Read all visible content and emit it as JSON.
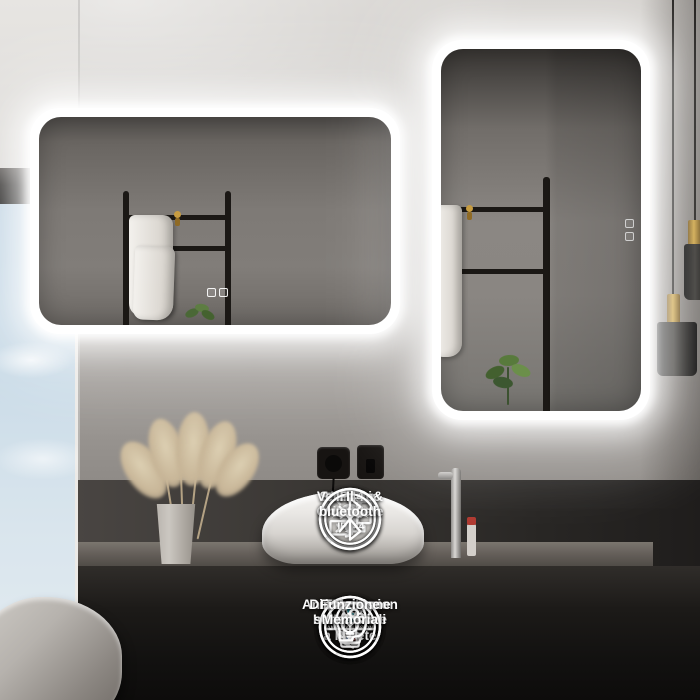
{
  "meta": {
    "description": "LED bathroom mirror product feature image",
    "language": "Italian"
  },
  "scene": {
    "mirrors": [
      {
        "name": "horizontal-led-mirror",
        "orientation": "horizontal",
        "lit": true
      },
      {
        "name": "vertical-led-mirror",
        "orientation": "vertical",
        "lit": true
      }
    ],
    "colors": {
      "led_glow": "#ffffff",
      "icon": "#ffffff",
      "touch_accent": "#3bc8dc",
      "hook_gold": "#c79c41",
      "pendant_gold": "#cda443",
      "sky": "#c9dbe7",
      "vanity_dark": "#121110"
    }
  },
  "features": [
    {
      "id": "hardwire",
      "icon": "hardwire-3x-icon",
      "badge": "3X",
      "label": "Hrdwire"
    },
    {
      "id": "led-mirror",
      "icon": "led-bulb-icon",
      "label": "Specchio\nLED"
    },
    {
      "id": "orientation",
      "icon": "vertical-horizontal-icon",
      "label": "Verticale&\nOrizontale"
    },
    {
      "id": "ip44",
      "icon": "ip44-waterproof-icon",
      "badge_ip": "IP",
      "badge_44": "44",
      "label": "IP44"
    },
    {
      "id": "bluetooth",
      "icon": "bluetooth-icon",
      "label": "Il bluetooth"
    },
    {
      "id": "anti-explosion",
      "icon": "anti-explosion-icon",
      "badge": "ANTI-EXPLOSION",
      "label": "Anti.Explosion"
    },
    {
      "id": "touch-switch",
      "icon": "touch-wall-switch-icon",
      "label": "Tocco o Interruttore\na Parete"
    },
    {
      "id": "anti-fog",
      "icon": "anti-fog-icon",
      "label": "Anti Nebbia"
    },
    {
      "id": "dimming",
      "icon": "stepless-dimming-icon",
      "label": "Diminuzione\nsenza scali"
    },
    {
      "id": "memory",
      "icon": "memory-function-icon",
      "label": "Funzione Memoria"
    }
  ]
}
